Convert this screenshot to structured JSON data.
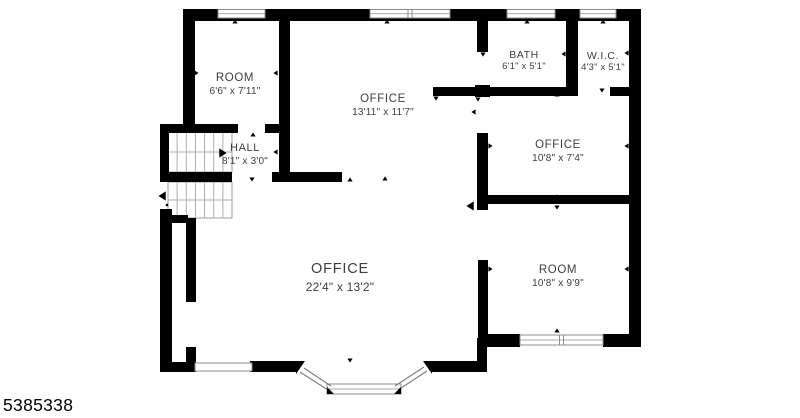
{
  "page": {
    "photo_id": "5385338"
  },
  "rooms": [
    {
      "name": "ROOM",
      "dims": "6'6\" x 7'11\""
    },
    {
      "name": "OFFICE",
      "dims": "13'11\" x 11'7\""
    },
    {
      "name": "BATH",
      "dims": "6'1\" x 5'1\""
    },
    {
      "name": "W.I.C.",
      "dims": "4'3\" x 5'1\""
    },
    {
      "name": "OFFICE",
      "dims": "10'8\" x 7'4\""
    },
    {
      "name": "HALL",
      "dims": "8'1\" x 3'0\""
    },
    {
      "name": "OFFICE",
      "dims": "22'4\" x 13'2\""
    },
    {
      "name": "ROOM",
      "dims": "10'8\" x 9'9\""
    }
  ],
  "plan": {
    "colors": {
      "wall": "#000000",
      "label": "#3e3e3e",
      "stair": "#aeaeae",
      "window": "#8c8c8c"
    },
    "walls": [
      [
        183,
        9,
        458,
        12
      ],
      [
        629,
        9,
        12,
        338
      ],
      [
        183,
        9,
        12,
        121
      ],
      [
        160,
        124,
        78,
        9
      ],
      [
        265,
        124,
        16,
        9
      ],
      [
        160,
        124,
        9,
        58
      ],
      [
        162,
        172,
        70,
        10
      ],
      [
        272,
        172,
        70,
        10
      ],
      [
        279,
        20,
        11,
        162
      ],
      [
        160,
        209,
        12,
        163
      ],
      [
        169,
        215,
        19,
        8
      ],
      [
        186,
        218,
        10,
        84
      ],
      [
        186,
        347,
        10,
        25
      ],
      [
        160,
        362,
        36,
        10
      ],
      [
        250,
        361,
        47,
        11
      ],
      [
        432,
        361,
        55,
        11
      ],
      [
        477,
        338,
        10,
        30
      ],
      [
        485,
        334,
        35,
        13
      ],
      [
        603,
        334,
        38,
        13
      ],
      [
        477,
        15,
        11,
        37
      ],
      [
        475,
        85,
        15,
        12
      ],
      [
        477,
        133,
        11,
        77
      ],
      [
        478,
        260,
        10,
        80
      ],
      [
        433,
        87,
        145,
        9
      ],
      [
        610,
        87,
        22,
        9
      ],
      [
        566,
        20,
        12,
        68
      ],
      [
        477,
        195,
        164,
        9
      ]
    ],
    "windows": [
      {
        "x": 218,
        "y": 9.5,
        "w": 47,
        "h": 8.5,
        "divided": false,
        "sash": true
      },
      {
        "x": 370,
        "y": 9.5,
        "w": 80,
        "h": 8.5,
        "divided": true,
        "sash": true
      },
      {
        "x": 507,
        "y": 9.5,
        "w": 48,
        "h": 8.5,
        "divided": false,
        "sash": true
      },
      {
        "x": 580,
        "y": 9.5,
        "w": 36,
        "h": 8.5,
        "divided": false,
        "sash": true
      },
      {
        "x": 520,
        "y": 335,
        "w": 83,
        "h": 10,
        "divided": true,
        "sash": true
      },
      {
        "x": 195,
        "y": 363,
        "w": 57,
        "h": 8,
        "divided": false,
        "sash": false
      }
    ],
    "stairs": [
      {
        "x": 168,
        "y": 132,
        "w": 64,
        "h": 40,
        "cols": 7,
        "mid": 152
      },
      {
        "x": 168,
        "y": 182,
        "w": 64,
        "h": 36,
        "cols": 7,
        "mid": 200
      }
    ],
    "bay": {
      "wedges": [
        [
          296,
          361,
          305,
          361,
          296,
          374
        ],
        [
          432,
          361,
          423,
          361,
          432,
          374
        ],
        [
          327,
          394,
          327,
          387,
          334,
          394
        ],
        [
          401,
          394,
          401,
          387,
          394,
          394
        ]
      ],
      "lines": [
        [
          300,
          372,
          328,
          390
        ],
        [
          304,
          368,
          331,
          386
        ],
        [
          398,
          390,
          427,
          371
        ],
        [
          395,
          386,
          424,
          367
        ]
      ],
      "center": {
        "x": 327,
        "y": 384,
        "w": 74,
        "h": 10
      }
    },
    "ticks": [
      [
        235,
        22,
        "u"
      ],
      [
        387,
        22,
        "u"
      ],
      [
        527,
        22,
        "u"
      ],
      [
        603,
        22,
        "u"
      ],
      [
        196,
        73,
        "r"
      ],
      [
        276,
        73,
        "l"
      ],
      [
        253,
        135,
        "u"
      ],
      [
        252,
        179,
        "d"
      ],
      [
        276,
        152,
        "l"
      ],
      [
        350,
        180,
        "u"
      ],
      [
        385,
        179,
        "u"
      ],
      [
        474,
        112,
        "l"
      ],
      [
        436,
        98,
        "d"
      ],
      [
        478,
        99,
        "d"
      ],
      [
        525,
        90,
        "u"
      ],
      [
        602,
        90,
        "d"
      ],
      [
        557,
        95,
        "u"
      ],
      [
        564,
        54,
        "l"
      ],
      [
        483,
        54,
        "d"
      ],
      [
        627,
        53,
        "l"
      ],
      [
        627,
        146,
        "l"
      ],
      [
        490,
        146,
        "r"
      ],
      [
        557,
        197,
        "u"
      ],
      [
        557,
        207,
        "d"
      ],
      [
        490,
        269,
        "r"
      ],
      [
        627,
        269,
        "l"
      ],
      [
        557,
        331,
        "u"
      ],
      [
        350,
        360,
        "d"
      ]
    ],
    "arrows": [
      [
        222,
        153,
        "r"
      ],
      [
        163,
        196,
        "l"
      ],
      [
        471,
        206,
        "l"
      ]
    ],
    "dot": [
      167,
      205
    ]
  }
}
